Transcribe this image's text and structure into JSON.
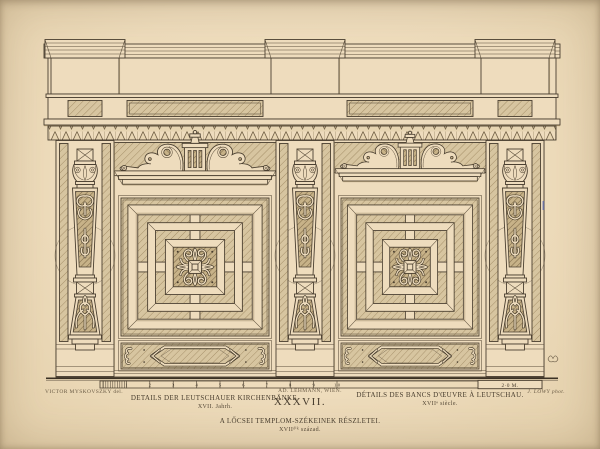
{
  "plate": {
    "number": "XXXVII.",
    "captions": {
      "german": {
        "title": "DETAILS DER LEUTSCHAUER KIRCHENBÄNKE.",
        "subtitle": "XVII. Jahrh."
      },
      "french": {
        "title": "DÉTAILS DES BANCS D'ŒUVRE À LEUTSCHAU.",
        "subtitle": "XVIIᵉ siècle."
      },
      "hungarian": {
        "title": "A LŐCSEI TEMPLOM-SZÉKEINEK RÉSZLETEI.",
        "subtitle": "XVIIᵈⁱᵏ század."
      }
    },
    "credits": {
      "artist": "VICTOR MYSKOVSZKY del.",
      "printer": "AD. LEHMANN, WIEN.",
      "photographer": "J. LÖWY phot."
    },
    "scale_bar": {
      "tick_labels": [
        "1",
        "2",
        "3",
        "4",
        "5",
        "6",
        "7",
        "8",
        "9",
        "1·0"
      ],
      "end_label": "2·0 M."
    },
    "colors": {
      "paper": "#eedcbd",
      "ink": "#473c2d"
    }
  }
}
